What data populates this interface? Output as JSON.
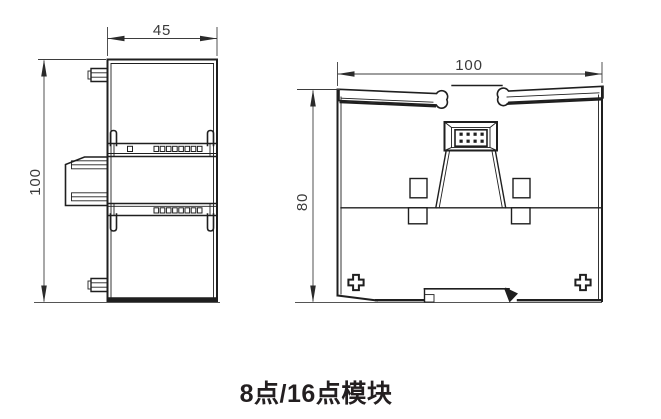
{
  "diagram": {
    "caption": "8点/16点模块",
    "dimensions": {
      "side_width": "45",
      "side_height": "100",
      "front_width": "100",
      "front_height": "80"
    },
    "colors": {
      "line": "#1f1f1f",
      "dimension": "#3d3d3d",
      "caption_text": "#231f20",
      "background": "#ffffff"
    }
  }
}
